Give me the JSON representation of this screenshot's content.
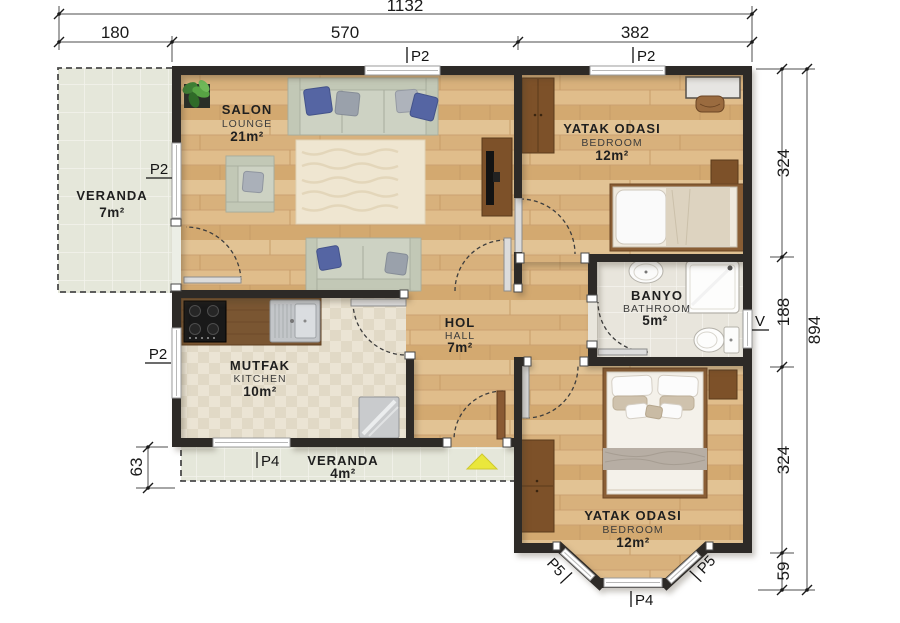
{
  "plan": {
    "rooms": {
      "veranda_left": {
        "name": "VERANDA",
        "area": "7m²"
      },
      "salon": {
        "name": "SALON",
        "sub": "LOUNGE",
        "area": "21m²"
      },
      "bedroom_top": {
        "name": "YATAK ODASI",
        "sub": "BEDROOM",
        "area": "12m²"
      },
      "bathroom": {
        "name": "BANYO",
        "sub": "BATHROOM",
        "area": "5m²"
      },
      "hall": {
        "name": "HOL",
        "sub": "HALL",
        "area": "7m²"
      },
      "kitchen": {
        "name": "MUTFAK",
        "sub": "KITCHEN",
        "area": "10m²"
      },
      "veranda_bottom": {
        "name": "VERANDA",
        "area": "4m²"
      },
      "bedroom_bottom": {
        "name": "YATAK ODASI",
        "sub": "BEDROOM",
        "area": "12m²"
      }
    },
    "openings": {
      "salon_window": "P2",
      "bedroom_top_window": "P2",
      "veranda_window": "P2",
      "kitchen_window": "P2",
      "veranda_door": "P4",
      "bay_window_center": "P4",
      "bay_window_left": "P5",
      "bay_window_right": "P5",
      "bathroom_window": "V"
    },
    "dimensions": {
      "top_total": "1132",
      "top_segments": [
        "180",
        "570",
        "382"
      ],
      "right_segments": [
        "324",
        "188",
        "324",
        "59"
      ],
      "right_total": "894",
      "left_segment": "63"
    },
    "colors": {
      "wall": "#2d2a27",
      "wood_floor": "#ddba88",
      "kitchen_tile": "#ebe4d4",
      "bath_tile": "#e8e5dc",
      "veranda_tile": "#e5e7da",
      "furniture_wood": "#7d5129",
      "sofa": "#cdd2c3",
      "accent_pillow": "#5565a3",
      "entrance_marker": "#eae73c"
    }
  }
}
